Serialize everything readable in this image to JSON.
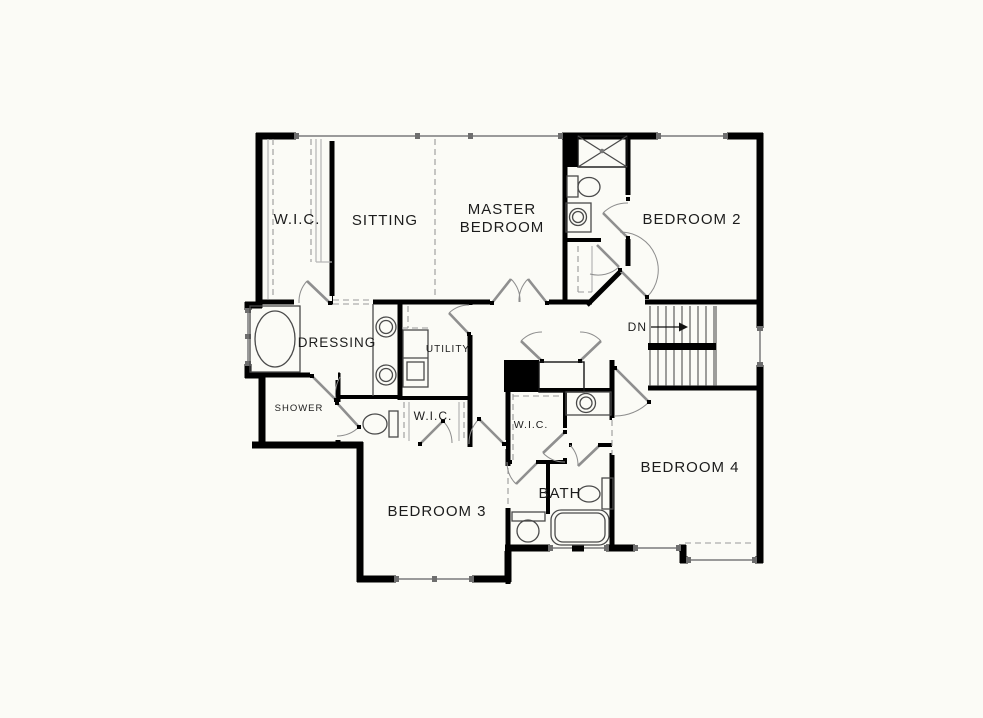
{
  "page": {
    "background": "#fbfbf6"
  },
  "plan": {
    "colors": {
      "wall": "#000000",
      "window": "#9a9a9a",
      "door": "#8f8f8f",
      "fixture": "#4a4a4a",
      "dashed": "#999999",
      "text": "#1c1c1c"
    },
    "rooms": {
      "wic_master": "W.I.C.",
      "sitting": "SITTING",
      "master_line1": "MASTER",
      "master_line2": "BEDROOM",
      "bedroom2": "BEDROOM 2",
      "dressing": "DRESSING",
      "utility": "UTILITY",
      "shower": "SHOWER",
      "wic_hall": "W.I.C.",
      "wic_bed4": "W.I.C.",
      "bedroom3": "BEDROOM 3",
      "bath": "BATH",
      "bedroom4": "BEDROOM 4",
      "stairs_down": "DN"
    }
  }
}
